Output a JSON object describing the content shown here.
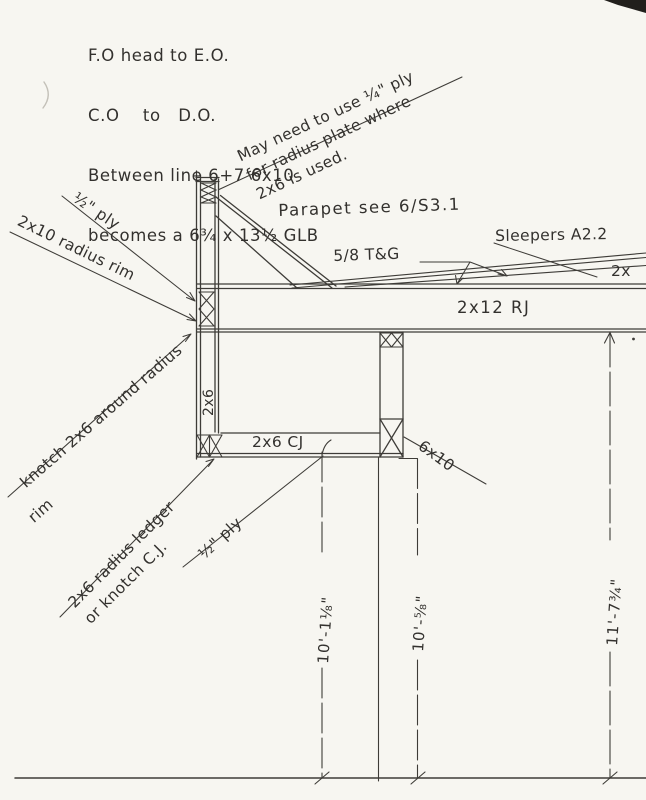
{
  "canvas": {
    "paper_color": "#f7f6f1",
    "ink_color": "#3e3c38"
  },
  "header_note": {
    "line1": "F.O head to E.O.",
    "line2": "C.O    to   D.O.",
    "line3": "Between line 6+7 6x10",
    "line4": "becomes a 6¾ x 13½ GLB"
  },
  "diagonal_note": {
    "line1": "May need to use ¼\" ply",
    "line2": "for radius plate where",
    "line3": "2x6  is used."
  },
  "callouts": {
    "ply_upper": "½\" ply",
    "radius_rim": "2x10 radius rim",
    "knotch_radius_line1": "knotch 2x6 around radius",
    "knotch_radius_line2": "rim",
    "stud_2x6": "2x6",
    "radius_ledger_line1": "2x6 radius ledger",
    "radius_ledger_line2": "or knotch C.J.",
    "ply_lower": "½\" ply",
    "parapet_ref": "Parapet see 6/S3.1",
    "tongue_groove": "5/8 T&G",
    "sleepers_ref": "Sleepers A2.2",
    "deck_2x": "2x",
    "roof_joist": "2x12 RJ",
    "ceiling_joist": "2x6 CJ",
    "beam_6x10": "6x10"
  },
  "dimensions": {
    "left": "10'-1⅛\"",
    "middle": "10'-⅝\"",
    "right": "11'-7¾\""
  }
}
